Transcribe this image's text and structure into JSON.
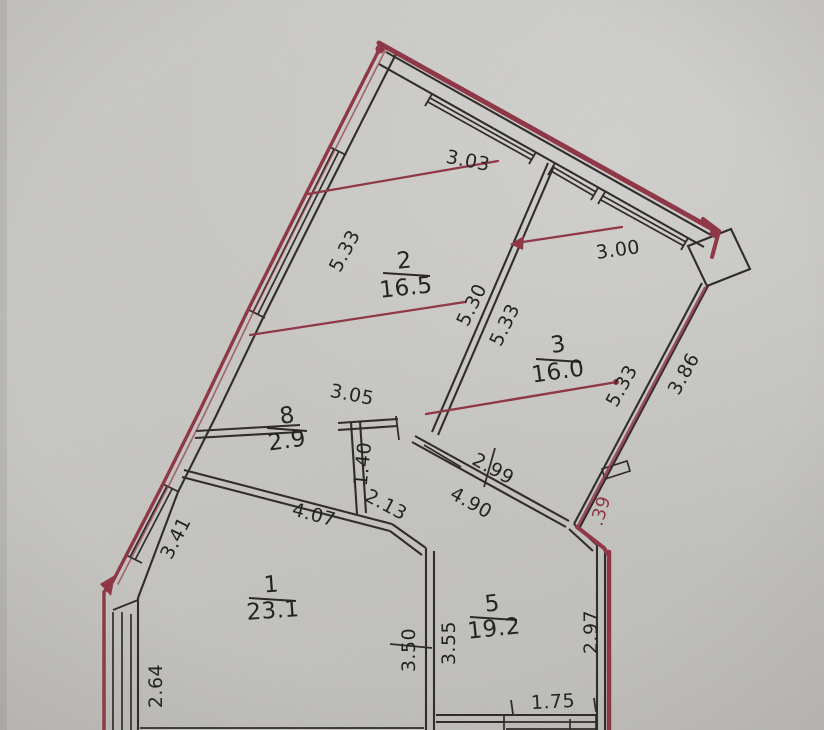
{
  "photo": {
    "paper_color": "#c7c6c2",
    "ink_color": "#2a2825",
    "marker_color": "#8d3242"
  },
  "rooms": [
    {
      "number": "1",
      "area": "23.1"
    },
    {
      "number": "2",
      "area": "16.5"
    },
    {
      "number": "3",
      "area": "16.0"
    },
    {
      "number": "5",
      "area": "19.2"
    },
    {
      "number": "8",
      "area": "2.9"
    }
  ],
  "dims": [
    {
      "label": "3.03"
    },
    {
      "label": "3.00"
    },
    {
      "label": "5.33"
    },
    {
      "label": "5.30"
    },
    {
      "label": "5.33"
    },
    {
      "label": "5.33"
    },
    {
      "label": "3.86"
    },
    {
      "label": "3.05"
    },
    {
      "label": "1.40"
    },
    {
      "label": "2.99"
    },
    {
      "label": "4.90"
    },
    {
      "label": "2.13"
    },
    {
      "label": "4.07"
    },
    {
      "label": "3.41"
    },
    {
      "label": "2.64"
    },
    {
      "label": "3.50"
    },
    {
      "label": "3.55"
    },
    {
      "label": "2.97"
    },
    {
      "label": "1.75"
    },
    {
      "label": ".39"
    },
    {
      "label": "5.22"
    }
  ]
}
